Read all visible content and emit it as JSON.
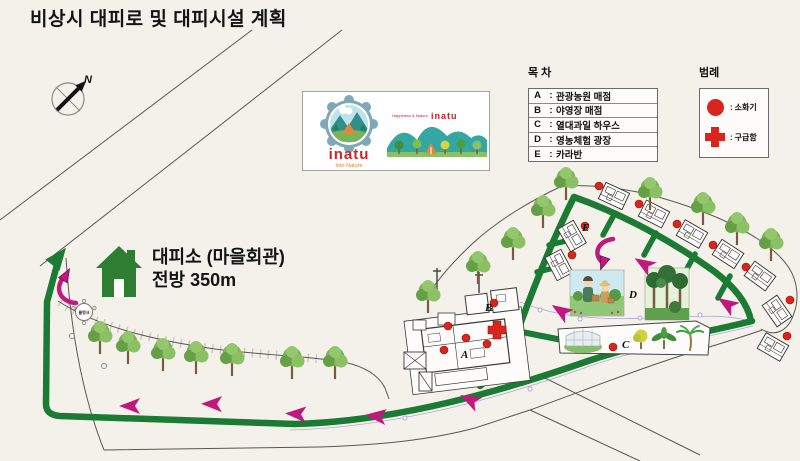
{
  "title": "비상시 대피로 및 대피시설 계획",
  "compass": {
    "north_label": "N"
  },
  "logo": {
    "brand": "inatu",
    "brand_sub": "Into Nature",
    "tagline": "Happiness & Nature",
    "brand_right": "inatu"
  },
  "index": {
    "heading": "목 차",
    "colon": ":",
    "items": [
      {
        "key": "A",
        "label": "관광농원 매점"
      },
      {
        "key": "B",
        "label": "야영장 매점"
      },
      {
        "key": "C",
        "label": "열대과일 하우스"
      },
      {
        "key": "D",
        "label": "영농체험 광장"
      },
      {
        "key": "E",
        "label": "카라반"
      }
    ]
  },
  "legend": {
    "heading": "범례",
    "colon": ":",
    "items": [
      {
        "icon": "fire-extinguisher-icon",
        "label": "소화기"
      },
      {
        "icon": "first-aid-icon",
        "label": "구급함"
      }
    ]
  },
  "shelter": {
    "line1": "대피소 (마을회관)",
    "line2": "전방 350m"
  },
  "map_labels": {
    "a": "A",
    "b": "B",
    "c": "C",
    "d": "D",
    "e": "E",
    "north": "N",
    "water_tank": "물탱크"
  },
  "colors": {
    "route_green": "#1b7a33",
    "arrow_magenta": "#c2187e",
    "marker_red": "#da251c",
    "brand_red": "#d2232a",
    "logo_teal": "#35a7a3"
  }
}
